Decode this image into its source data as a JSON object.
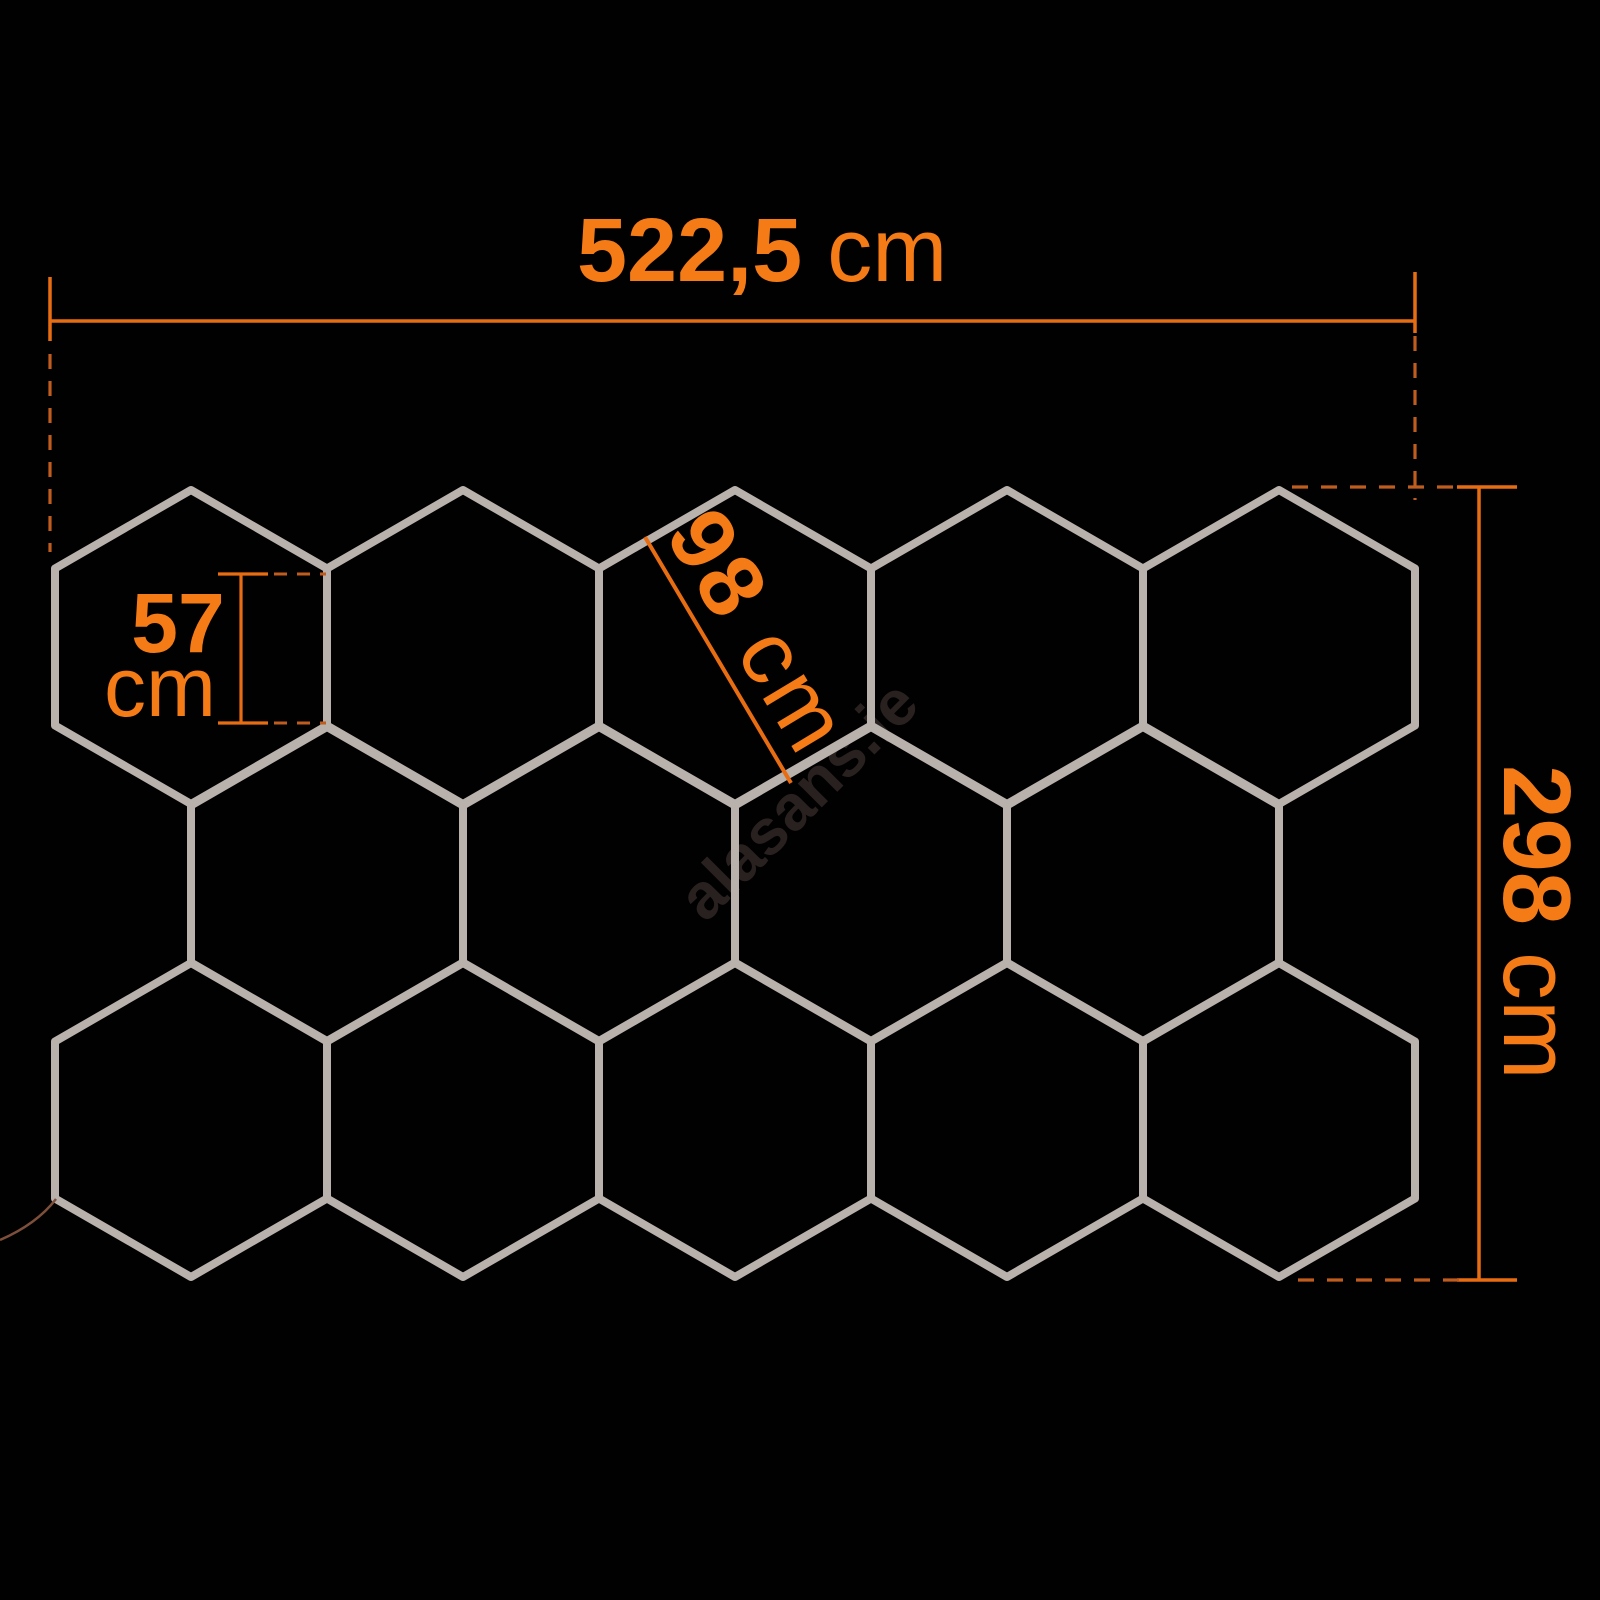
{
  "canvas": {
    "background": "#010101"
  },
  "watermark": {
    "text": "alasans.ie",
    "color": "#282120",
    "rotation_deg": -45,
    "font_size": 64
  },
  "honeycomb": {
    "stroke_color": "#b9b1ac",
    "stroke_width": 8,
    "side": 157,
    "half_width": 136,
    "hexagon_count": 14,
    "rows": [
      {
        "cy": 647,
        "cx": [
          191,
          463,
          735,
          1007,
          1279
        ]
      },
      {
        "cy": 884,
        "cx": [
          327,
          599,
          871,
          1143
        ]
      },
      {
        "cy": 1120,
        "cx": [
          191,
          463,
          735,
          1007,
          1279
        ]
      }
    ]
  },
  "cable": {
    "color": "#7d4f3a",
    "width": 2.5,
    "path": "M56,1199 C46,1212 30,1227 0,1240"
  },
  "colors": {
    "label_orange": "#f57b17",
    "line_orange": "#e86d12",
    "dash_orange": "#bf5c1e"
  },
  "dims": {
    "top": {
      "value": "522,5",
      "unit": "cm"
    },
    "right": {
      "value": "298",
      "unit": "cm"
    },
    "side57": {
      "value": "57",
      "unit": "cm"
    },
    "diag98": {
      "value": "98",
      "unit": "cm"
    }
  }
}
